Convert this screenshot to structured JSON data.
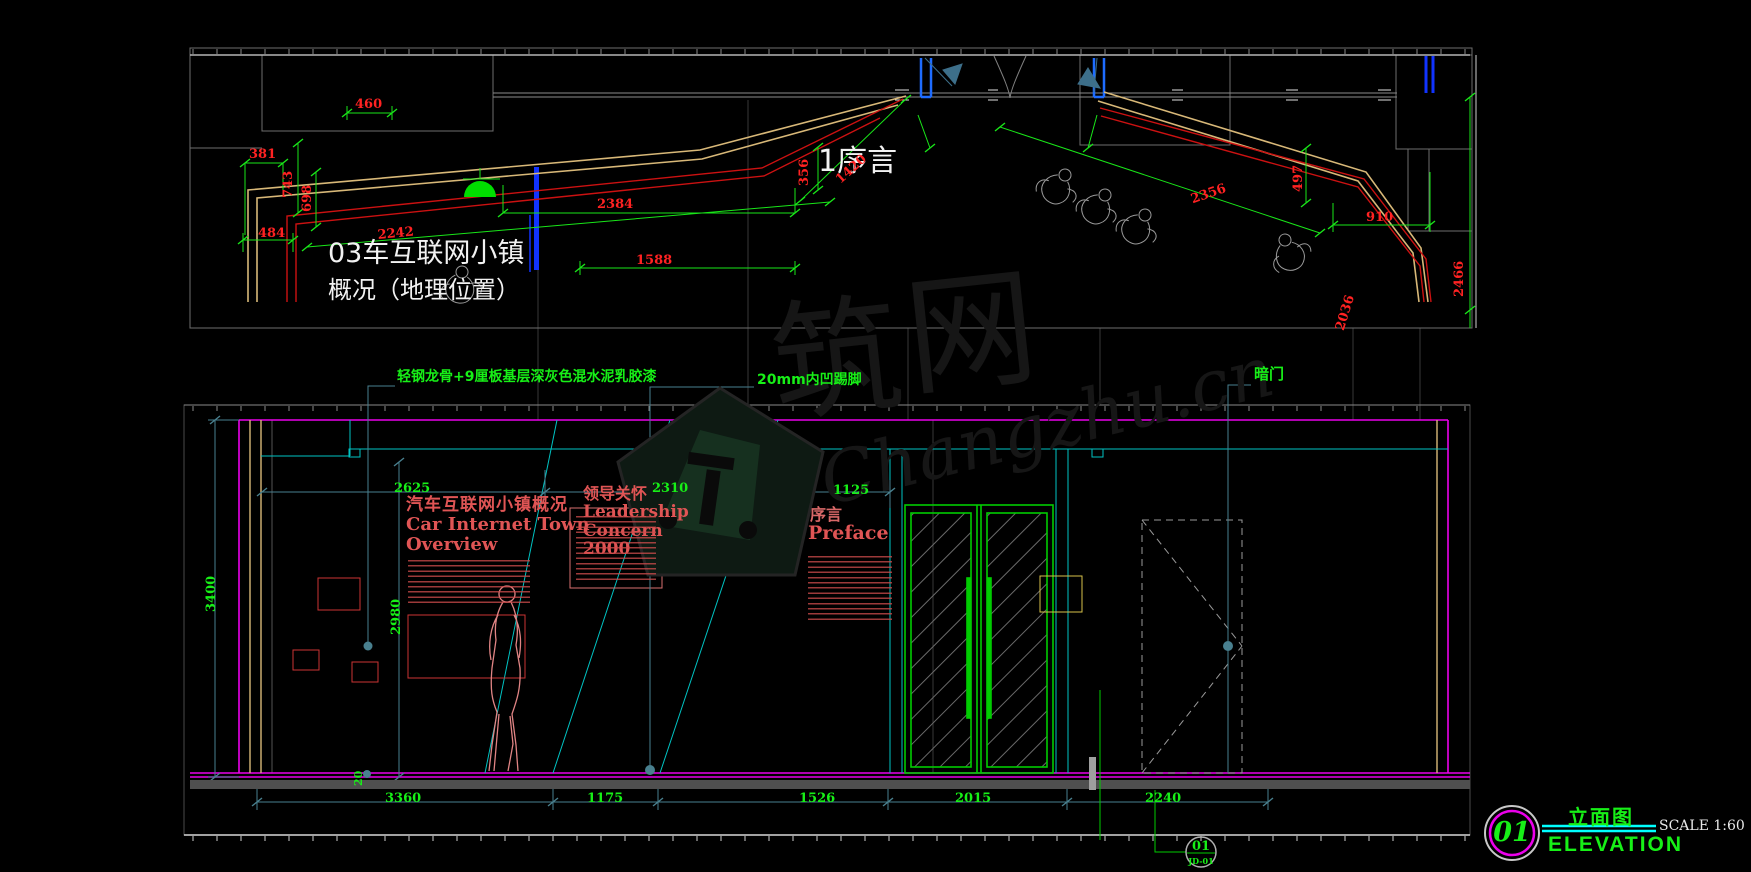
{
  "top_plan": {
    "label_serial": "1序言",
    "caption_line1": "03车互联网小镇",
    "caption_line2": "概况（地理位置）",
    "dims": {
      "d460": "460",
      "d381": "381",
      "d743": "743",
      "d698": "698",
      "d484": "484",
      "d2242": "2242",
      "d2384": "2384",
      "d1588": "1588",
      "d356": "356",
      "d1420": "1420",
      "d2356": "2356",
      "d497": "497",
      "d910": "910",
      "d2466": "2466",
      "d2036": "2036"
    }
  },
  "notes": {
    "n1": "轻钢龙骨+9厘板基层深灰色混水泥乳胶漆",
    "n2": "20mm内凹踢脚",
    "n3": "暗门"
  },
  "elevation": {
    "boards": {
      "b1_cn": "汽车互联网小镇概况",
      "b1_en1": "Car Internet Town",
      "b1_en2": "Overview",
      "b2_cn": "领导关怀",
      "b2_en1": "Leadership",
      "b2_en2": "Concern",
      "b2_en3": "2000",
      "b3_cn": "序言",
      "b3_en": "Preface"
    },
    "dims": {
      "t2625": "2625",
      "t2310": "2310",
      "t1125": "1125",
      "v3400": "3400",
      "v2980": "2980",
      "s20": "20",
      "b3360": "3360",
      "b1175": "1175",
      "b1526": "1526",
      "b2015": "2015",
      "b2240": "2240"
    },
    "callout": {
      "num": "01",
      "code": "JD-01"
    }
  },
  "titleblock": {
    "num": "01",
    "title_cn": "立面图",
    "title_en": "ELEVATION",
    "scale": "SCALE 1:60"
  },
  "watermark": {
    "char1": "筑",
    "char2": "网",
    "script": "Changzhu.cn"
  }
}
